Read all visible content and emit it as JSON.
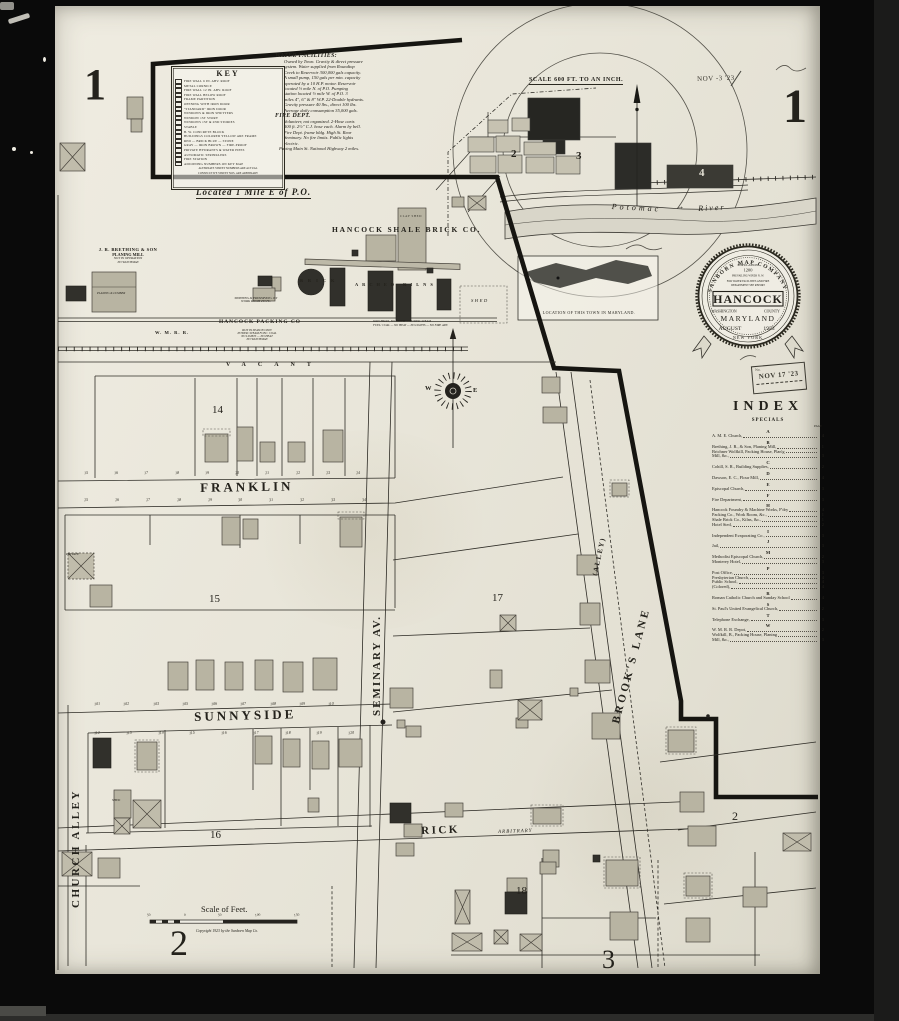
{
  "sheet": {
    "number_left": "1",
    "number_right": "1",
    "located_note": "Located 1 Mile E of P.O.",
    "date_stamp": "NOV -3 '23",
    "received_no": "No.",
    "received_date": "NOV 17 '23"
  },
  "key": {
    "title": "KEY",
    "lines": [
      "FIRE WALL 6 IN. ABV. ROOF",
      "METAL CORNICE",
      "FIRE WALL 12 IN. ABV. ROOF",
      "FIRE WALL BELOW ROOF",
      "FRAME PARTITION",
      "OPENING WITH IRON DOOR",
      "\"STANDARD\" IRON DOOR",
      "WINDOWS & IRON SHUTTERS",
      "WINDOW 1ST STORY",
      "WINDOWS 1ST & 2ND STORIES",
      "STABLE",
      "B. W. CONCRETE BLOCK",
      "BUILDINGS COLORED YELLOW ARE FRAME",
      "RED — BRICK     BLUE — STONE",
      "GRAY — IRON     BROWN — FIRE-PROOF",
      "PRIVATE HYDRANTS & WATER PIPES",
      "AUTOMATIC SPRINKLERS",
      "FIRE STATION",
      "ADJOINING NUMBERS ON KEY MAP"
    ],
    "footer": [
      "ALTERNATE STREET NUMBERS ARE ACTUAL",
      "CONSECUTIVE STREET NOS. ARE ARBITRARY"
    ]
  },
  "report": {
    "water_title": "WATER FACILITIES:",
    "water_lines": [
      "Owned by Town. Gravity & direct pressure",
      "system. Water supplied from Roundtop",
      "Creek to Reservoir 300,000 gals capacity.",
      "A small pump, 150 gals per min. capacity",
      "operated by a 10 H.P. motor. Reservoir",
      "located ½ mile N. of P.O. Pumping",
      "station located ½ mile W. of P.O. 3",
      "miles 4\", 6\" & 8\" W.P.  22-Double hydrants.",
      "Gravity pressure 40 lbs., direct 100 lbs.",
      "Average daily consumption 35,000 gals."
    ],
    "fire_title": "FIRE DEPT.",
    "fire_lines": [
      "Volunteer, not organized.  2-Hose carts",
      "500 ft. 2½\" C.J. hose each.  Alarm by bell.",
      "Fire Dept. frame bldg. High St. Rear",
      "Seminary.  No fire limits.  Public lights",
      "electric."
    ],
    "paving_line": "Paving Main St.  National Highway 2 miles."
  },
  "overview": {
    "scale_label": "SCALE 600 FT. TO AN INCH.",
    "river_word1": "Potomac",
    "river_word2": "River",
    "d2": "2",
    "d3": "3",
    "d4": "4"
  },
  "inset": {
    "caption": "LOCATION OF THIS TOWN IN MARYLAND."
  },
  "seal": {
    "ring_top": "SANBORN MAP COMPANY",
    "population_label": "POPULATION",
    "population": "1200",
    "winds": "PREVAILING WINDS  N. W.",
    "note1": "FOR WATER FACILITIES AND FIRE",
    "note2": "DEPARTMENT SEE REPORT",
    "town": "HANCOCK",
    "county_l": "WASHINGTON",
    "county_r": "COUNTY",
    "state": "MARYLAND",
    "date_month": "AUGUST",
    "date_year": "1923",
    "ring_bottom": "NEW YORK"
  },
  "index": {
    "title": "INDEX",
    "subtitle": "SPECIALS",
    "page_label": "PAGE",
    "sections": [
      {
        "letter": "A",
        "entries": [
          {
            "t": "A. M. E. Church,",
            "p": "4"
          }
        ]
      },
      {
        "letter": "B",
        "entries": [
          {
            "t": "Brething, J. R., & Son, Planing Mill,",
            "p": "1"
          },
          {
            "t": "Brichner Wolfkill, Packing House, Plan'g",
            "p": ""
          },
          {
            "t": "   Mill, &c.,",
            "p": "3"
          }
        ]
      },
      {
        "letter": "C",
        "entries": [
          {
            "t": "Cohill, S. R., Building Supplies,",
            "p": "2"
          }
        ]
      },
      {
        "letter": "D",
        "entries": [
          {
            "t": "Dawson, E. C., Flour Mill,",
            "p": "4"
          }
        ]
      },
      {
        "letter": "E",
        "entries": [
          {
            "t": "Episcopal Church,",
            "p": "3"
          }
        ]
      },
      {
        "letter": "F",
        "entries": [
          {
            "t": "Fire Department,",
            "p": "3"
          }
        ]
      },
      {
        "letter": "H",
        "entries": [
          {
            "t": "Hancock Foundry & Machine Works, F'dry",
            "p": "4"
          },
          {
            "t": "   Packing Co., Work Room, &c.,",
            "p": "1"
          },
          {
            "t": "   Shale Brick Co., Kilns, &c.,",
            "p": "1"
          },
          {
            "t": "Hotel Sted,",
            "p": "2"
          }
        ]
      },
      {
        "letter": "I",
        "entries": [
          {
            "t": "Independent Evaporating Co.,",
            "p": "3"
          }
        ]
      },
      {
        "letter": "J",
        "entries": [
          {
            "t": "Jail,",
            "p": "3"
          }
        ]
      },
      {
        "letter": "M",
        "entries": [
          {
            "t": "Methodist Episcopal Church,",
            "p": "2"
          },
          {
            "t": "Monterey Hotel,",
            "p": "3"
          }
        ]
      },
      {
        "letter": "P",
        "entries": [
          {
            "t": "Post Office,",
            "p": "3"
          },
          {
            "t": "Presbyterian Church,",
            "p": "4"
          },
          {
            "t": "Public School,",
            "p": "4"
          },
          {
            "t": "      (Colored),",
            "p": "4"
          }
        ]
      },
      {
        "letter": "R",
        "entries": [
          {
            "t": "Roman Catholic Church and Sunday School",
            "p": "4"
          }
        ]
      },
      {
        "letter": "S",
        "entries": [
          {
            "t": "St. Paul's United Evangelical Church,",
            "p": "2"
          }
        ]
      },
      {
        "letter": "T",
        "entries": [
          {
            "t": "Telephone Exchange,",
            "p": "3"
          }
        ]
      },
      {
        "letter": "W",
        "entries": [
          {
            "t": "W. M. R. R. Depot,",
            "p": "2"
          },
          {
            "t": "Wolfkill, B., Packing House, Planing",
            "p": ""
          },
          {
            "t": "   Mill, &c.,",
            "p": "3"
          }
        ]
      }
    ]
  },
  "industry": {
    "brick_co": "HANCOCK SHALE BRICK CO.",
    "clay_shed": "CLAY SHED",
    "brick_word": "BRICK",
    "kilns_word": "ARCHED KILNS",
    "shed": "SHED",
    "brick_note1": "WATCHMAN, NO CLOCK — POWER: STEAM",
    "brick_note2": "FUEL: COAL — NO HEAT — NO LIGHTS — NO FIRE APP.",
    "planing1": "J. R. BRETHING & SON",
    "planing2": "PLANING MILL",
    "planing3": "NOT IN OPERATION",
    "planing4": "NO WATCHMAN",
    "planing_bldg": "PLANING & LUMBER",
    "shipping1": "SHIPPING & PRESERVING 1ST",
    "shipping2": "WORK ROOM 2'D FL.",
    "packing_name": "HANCOCK PACKING CO",
    "packing_note1": "RUN IN SEASON ONLY",
    "packing_note2": "POWER: STEAM  FUEL: COAL",
    "packing_note3": "NO LIGHTS — NO HEAT",
    "packing_note4": "NO WATCHMAN",
    "railroad": "W. M. R. R."
  },
  "streets": {
    "franklin": "FRANKLIN",
    "sunnyside": "SUNNYSIDE",
    "seminary": "SEMINARY  AV.",
    "brooks": "BROOK'S  LANE",
    "alley": "(ALLEY)",
    "church_alley": "CHURCH  ALLEY",
    "rick": "RICK",
    "rick_note": "ARBITRARY",
    "vacant": "VACANT"
  },
  "blocks": {
    "b14": "14",
    "b15": "15",
    "b16": "16",
    "b17": "17",
    "b18": "18",
    "right_block": "2",
    "private_note": "PRIVATE",
    "shed": "SHED"
  },
  "numbers": {
    "franklin_north": [
      "15",
      "16",
      "17",
      "18",
      "19",
      "20",
      "21",
      "22",
      "23",
      "24"
    ],
    "franklin_south": [
      "25",
      "26",
      "27",
      "28",
      "29",
      "30",
      "31",
      "32",
      "33",
      "34"
    ],
    "sunnyside_north": [
      "101",
      "102",
      "103",
      "105",
      "106",
      "107",
      "108",
      "109",
      "110"
    ],
    "sunnyside_south": [
      "112",
      "113",
      "114",
      "115",
      "116",
      "117",
      "118",
      "119",
      "120"
    ]
  },
  "compass": {
    "w": "W",
    "e": "E"
  },
  "footer": {
    "scale_title": "Scale of Feet.",
    "ticks": [
      "50",
      "0",
      "50",
      "100",
      "150"
    ],
    "copyright": "Copyright 1923 by the Sanborn Map Co.",
    "page_left": "2",
    "page_right": "3"
  }
}
